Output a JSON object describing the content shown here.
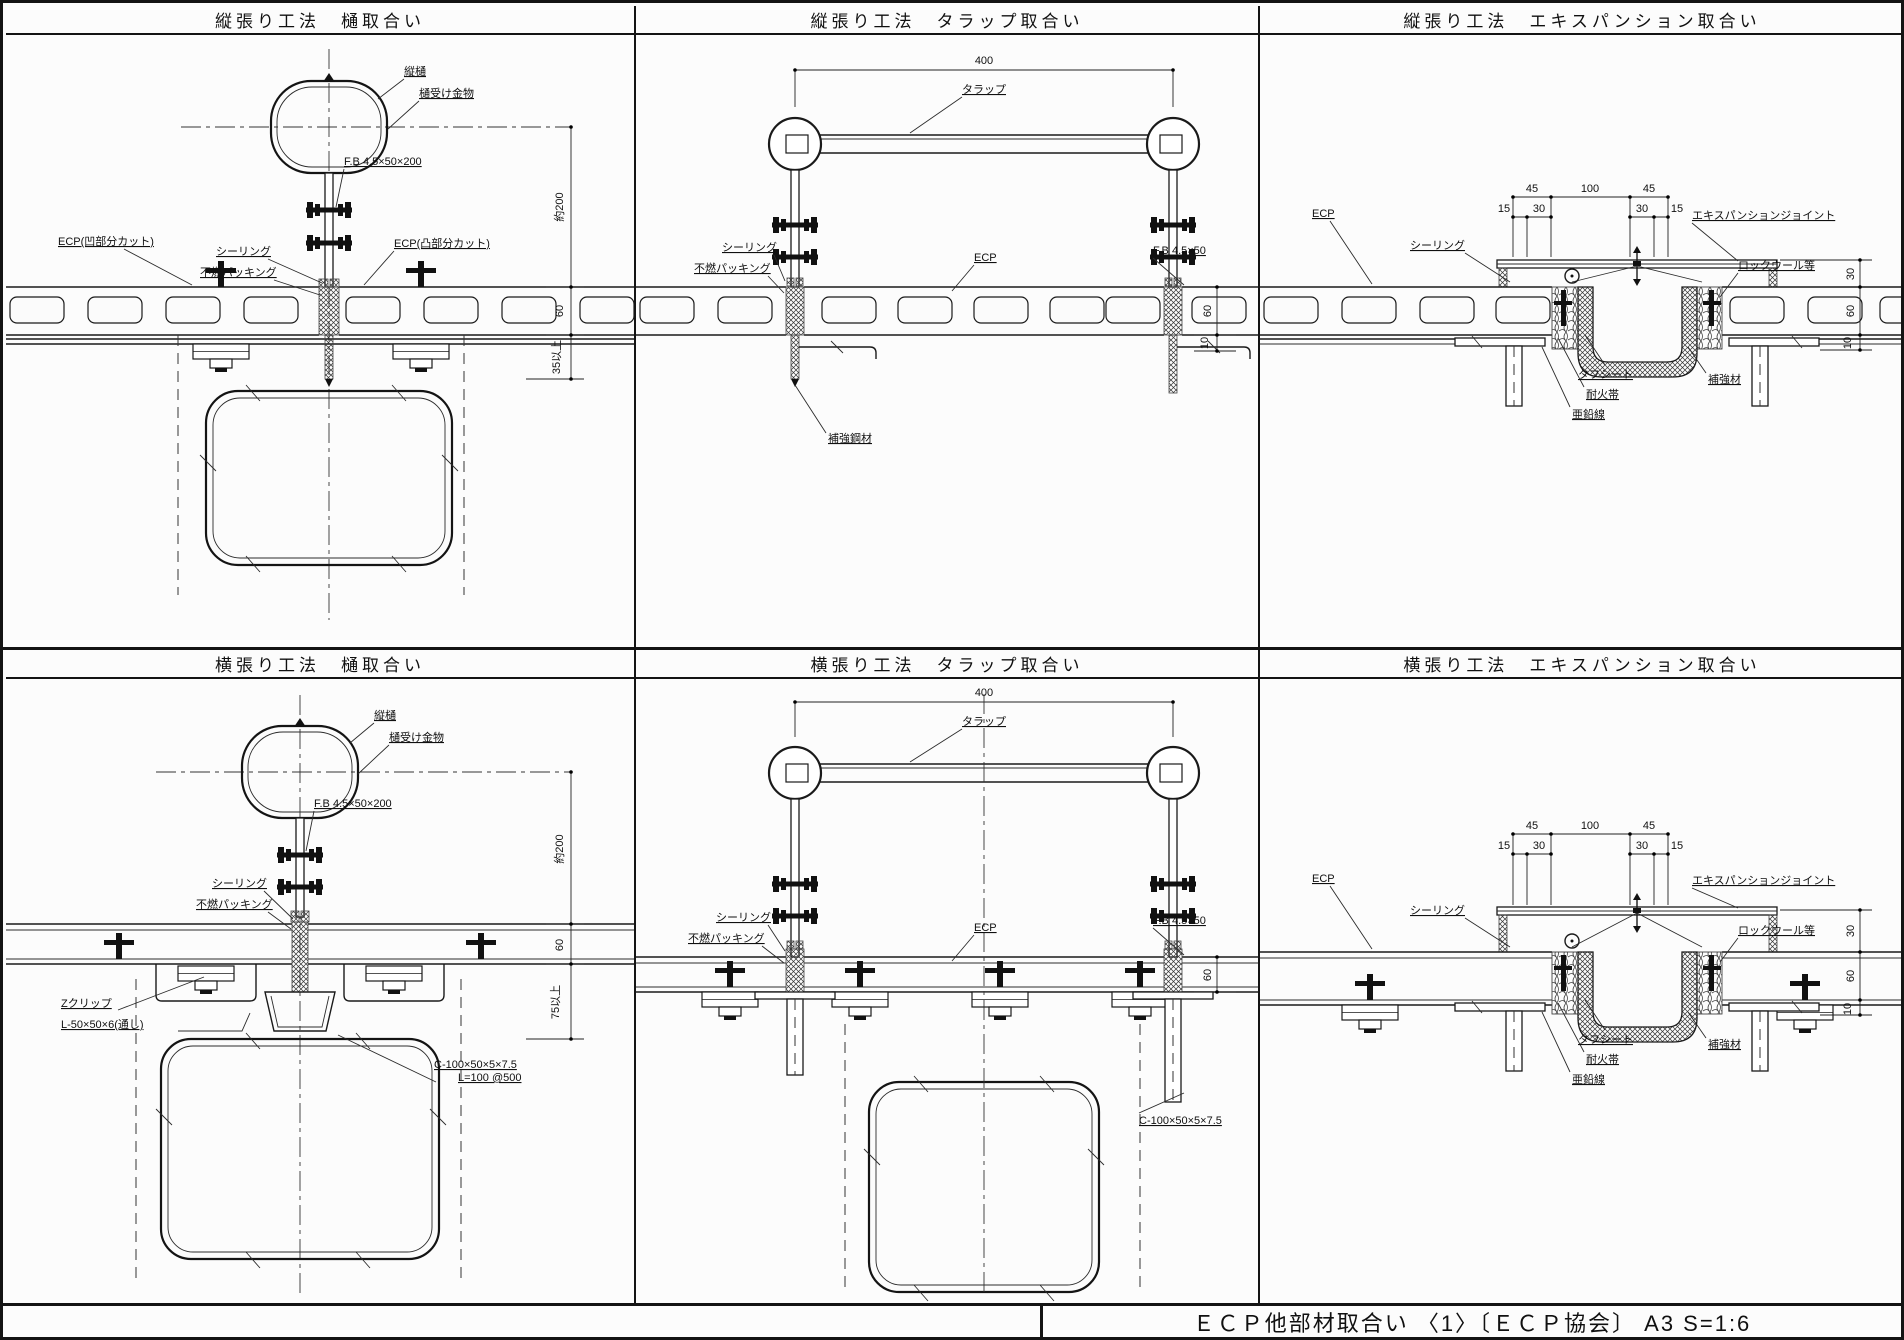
{
  "footer": {
    "text": "ＥＣＰ他部材取合い 〈1〉〔ＥＣＰ協会〕 A3 S=1:6"
  },
  "panels": [
    {
      "title": "縦張り工法　樋取合い",
      "labels": {
        "downpipe": "縦樋",
        "bracket": "樋受け金物",
        "fb": "F.B 4.5×50×200",
        "sealing": "シーリング",
        "packing": "不燃パッキング",
        "ecp_left": "ECP(凹部分カット)",
        "ecp_right": "ECP(凸部分カット)"
      },
      "dims": {
        "d200": "約200",
        "d60": "60",
        "d35": "35以上"
      }
    },
    {
      "title": "縦張り工法　タラップ取合い",
      "labels": {
        "ladder": "タラップ",
        "sealing": "シーリング",
        "packing": "不燃パッキング",
        "ecp": "ECP",
        "fb": "F.B 4.5×50",
        "reinforce": "補強鋼材"
      },
      "dims": {
        "d400": "400",
        "d60": "60",
        "d10": "10"
      }
    },
    {
      "title": "縦張り工法　エキスパンション取合い",
      "labels": {
        "exp": "エキスパンションジョイント",
        "sealing": "シーリング",
        "rockwool": "ロックウール等",
        "ecp": "ECP",
        "sheet": "タフシート",
        "fireband": "耐火帯",
        "wire": "亜鉛線",
        "reinforce": "補強材"
      },
      "dims": {
        "d45a": "45",
        "d100": "100",
        "d45b": "45",
        "d15a": "15",
        "d30a": "30",
        "d30b": "30",
        "d15b": "15",
        "d30": "30",
        "d60": "60",
        "d10": "10"
      }
    },
    {
      "title": "横張り工法　樋取合い",
      "labels": {
        "downpipe": "縦樋",
        "bracket": "樋受け金物",
        "fb": "F.B 4.5×50×200",
        "sealing": "シーリング",
        "packing": "不燃パッキング",
        "zclip": "Zクリップ",
        "angle": "L-50×50×6(通し)",
        "channel": "C-100×50×5×7.5",
        "channel_pitch": "L=100 @500"
      },
      "dims": {
        "d200": "約200",
        "d60": "60",
        "d75": "75以上"
      }
    },
    {
      "title": "横張り工法　タラップ取合い",
      "labels": {
        "ladder": "タラップ",
        "sealing": "シーリング",
        "packing": "不燃パッキング",
        "ecp": "ECP",
        "fb": "F.B 4.5×50",
        "channel": "C-100×50×5×7.5"
      },
      "dims": {
        "d400": "400",
        "d60": "60"
      }
    },
    {
      "title": "横張り工法　エキスパンション取合い",
      "labels": {
        "exp": "エキスパンションジョイント",
        "sealing": "シーリング",
        "rockwool": "ロックウール等",
        "ecp": "ECP",
        "sheet": "タフシート",
        "fireband": "耐火帯",
        "wire": "亜鉛線",
        "reinforce": "補強材"
      },
      "dims": {
        "d45a": "45",
        "d100": "100",
        "d45b": "45",
        "d15a": "15",
        "d30a": "30",
        "d30b": "30",
        "d15b": "15",
        "d30": "30",
        "d60": "60",
        "d10": "10"
      }
    }
  ]
}
